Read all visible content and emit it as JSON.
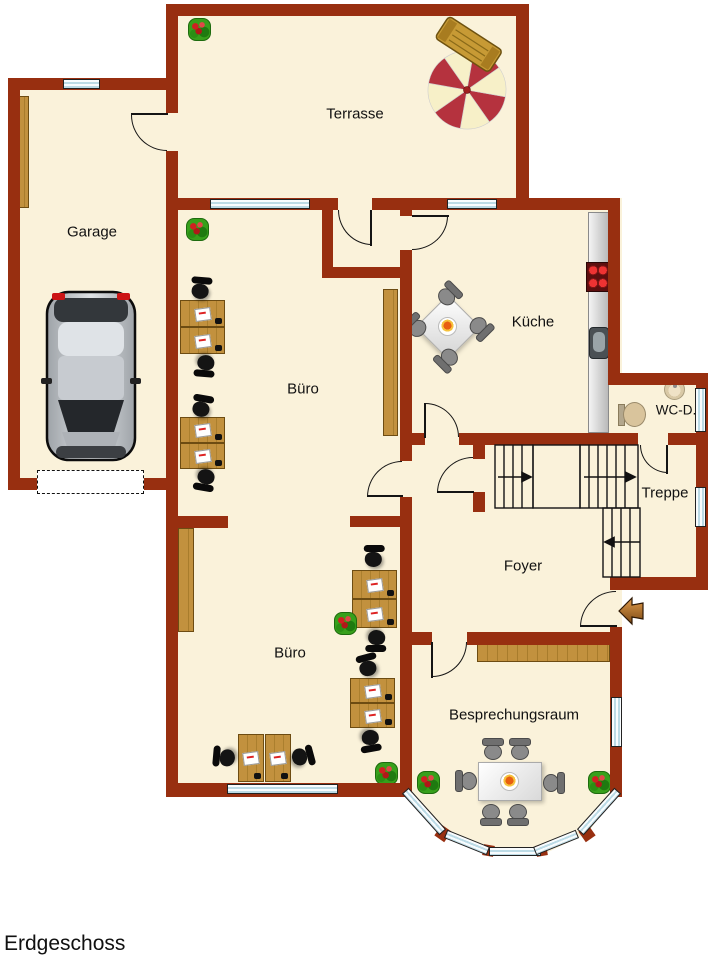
{
  "title": "Erdgeschoss",
  "rooms": {
    "terrasse": "Terrasse",
    "garage": "Garage",
    "buero_oben": "Büro",
    "kueche": "Küche",
    "wc": "WC-D.",
    "treppe": "Treppe",
    "foyer": "Foyer",
    "buero_unten": "Büro",
    "besprechungsraum": "Besprechungsraum"
  },
  "colors": {
    "wall": "#982F10",
    "floor": "#FAF2DA",
    "wood": "#C2913E",
    "window": "#BCDBE6",
    "plantGreen": "#37A01B",
    "flowerRed": "#CF2020",
    "chairDark": "#141414",
    "chairGray": "#8A8A8A",
    "arrowOrange": "#D08A3C",
    "text": "#111111"
  }
}
